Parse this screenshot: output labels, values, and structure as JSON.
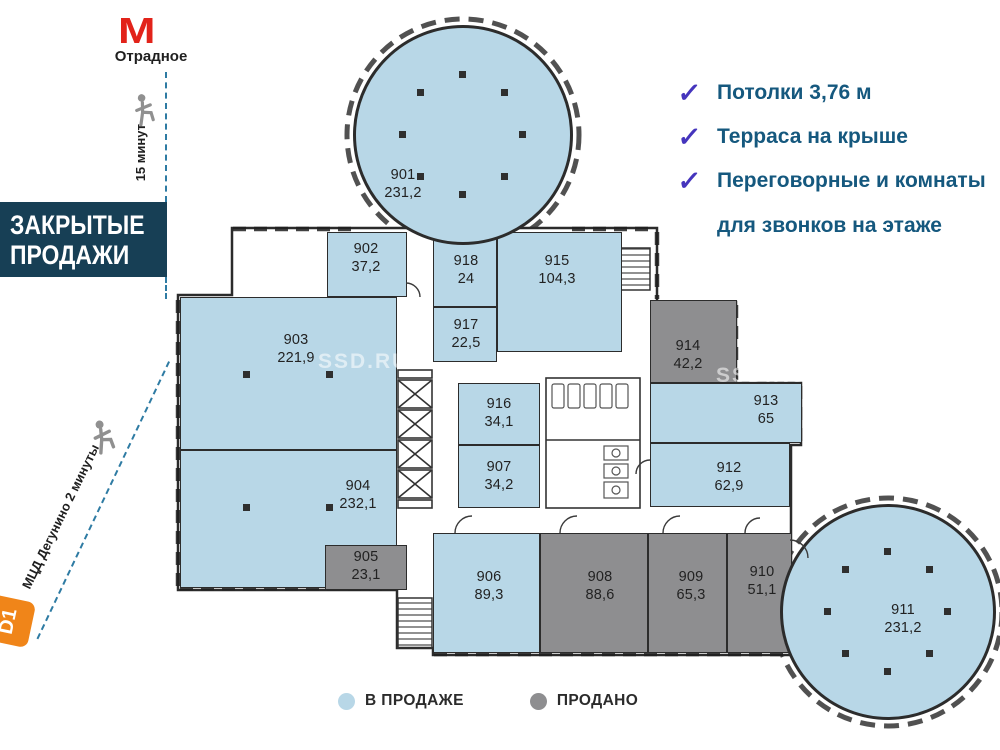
{
  "transit": {
    "metro_icon": "М",
    "metro_station": "Отрадное",
    "metro_walk_time": "15 минут",
    "mcd_label": "МЦД Дегунино 2 минуты",
    "mcd_badge": "D1"
  },
  "banner": {
    "line1": "ЗАКРЫТЫЕ",
    "line2": "ПРОДАЖИ"
  },
  "features": [
    {
      "check": "✓",
      "text": "Потолки 3,76 м"
    },
    {
      "check": "✓",
      "text": "Терраса на крыше"
    },
    {
      "check": "✓",
      "text": "Переговорные и комнаты",
      "text2": "для звонков на этаже"
    }
  ],
  "legend": [
    {
      "label": "В ПРОДАЖЕ",
      "color": "#b8d7e7",
      "status": "available"
    },
    {
      "label": "ПРОДАНО",
      "color": "#8e8e90",
      "status": "sold"
    }
  ],
  "watermark": "SSD.RU",
  "rooms": [
    {
      "number": "901",
      "area": "231,2",
      "status": "available"
    },
    {
      "number": "902",
      "area": "37,2",
      "status": "available"
    },
    {
      "number": "903",
      "area": "221,9",
      "status": "available"
    },
    {
      "number": "904",
      "area": "232,1",
      "status": "available"
    },
    {
      "number": "905",
      "area": "23,1",
      "status": "sold"
    },
    {
      "number": "906",
      "area": "89,3",
      "status": "available"
    },
    {
      "number": "907",
      "area": "34,2",
      "status": "available"
    },
    {
      "number": "908",
      "area": "88,6",
      "status": "sold"
    },
    {
      "number": "909",
      "area": "65,3",
      "status": "sold"
    },
    {
      "number": "910",
      "area": "51,1",
      "status": "sold"
    },
    {
      "number": "911",
      "area": "231,2",
      "status": "available"
    },
    {
      "number": "912",
      "area": "62,9",
      "status": "available"
    },
    {
      "number": "913",
      "area": "65",
      "status": "available"
    },
    {
      "number": "914",
      "area": "42,2",
      "status": "sold"
    },
    {
      "number": "915",
      "area": "104,3",
      "status": "available"
    },
    {
      "number": "916",
      "area": "34,1",
      "status": "available"
    },
    {
      "number": "917",
      "area": "22,5",
      "status": "available"
    },
    {
      "number": "918",
      "area": "24",
      "status": "available"
    }
  ]
}
